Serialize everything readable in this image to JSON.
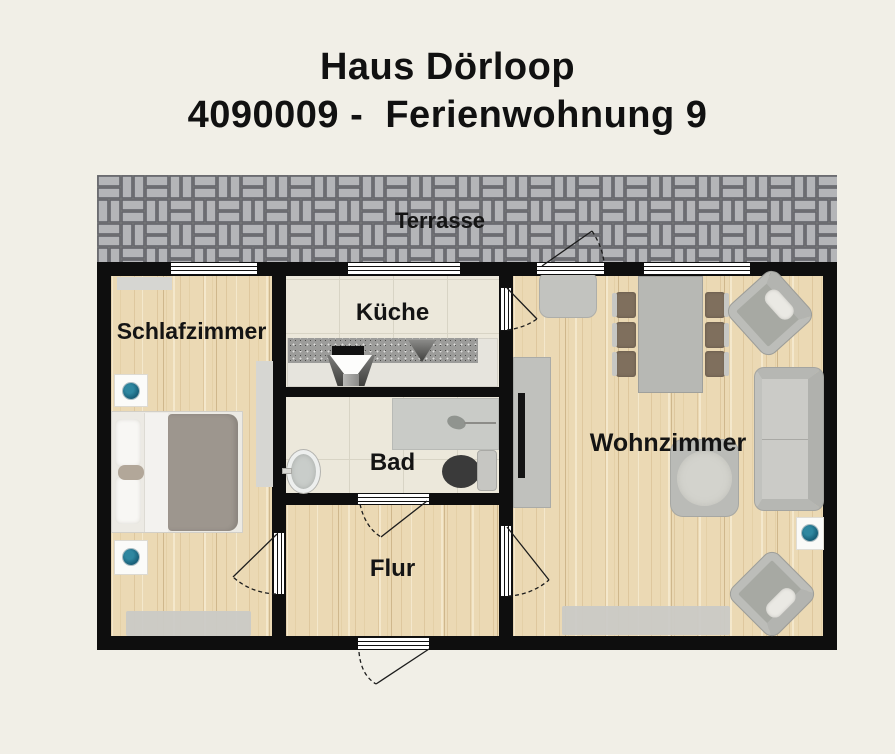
{
  "title": {
    "line1": "Haus Dörloop",
    "line2": "4090009 -  Ferienwohnung 9"
  },
  "rooms": {
    "terrasse": "Terrasse",
    "schlafzimmer": "Schlafzimmer",
    "kueche": "Küche",
    "bad": "Bad",
    "flur": "Flur",
    "wohnzimmer": "Wohnzimmer"
  },
  "colors": {
    "background": "#f1efe7",
    "wall": "#0e0e0e",
    "wood_floor": "#ebd9b4",
    "tile_floor": "#ece8db",
    "paver_block": "#b4b5b8",
    "paver_joint": "#66676b",
    "lamp_accent": "#1a6b84",
    "furniture_grey": "#c2c3bf",
    "blanket_grey": "#9d968e",
    "chair_brown": "#7f6f5d"
  }
}
